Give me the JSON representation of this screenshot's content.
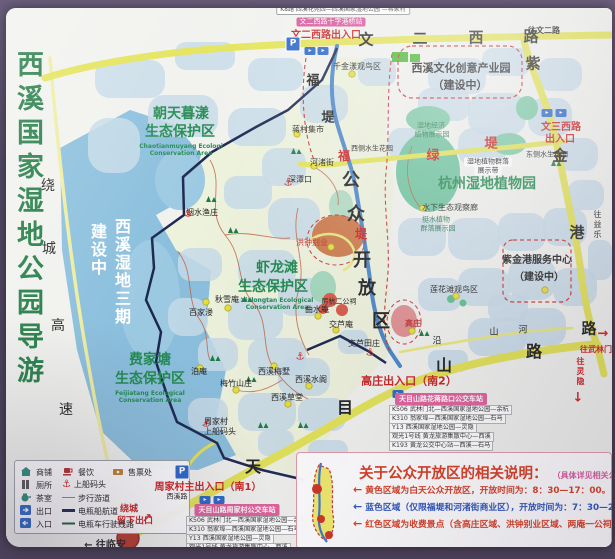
{
  "poster": {
    "title": "西溪国家湿地公园导游图"
  },
  "colors": {
    "road_yellow": "#e3e356",
    "water_lake": "#8abfdd",
    "pond": "#c6dae8",
    "boundary_navy": "#1c2750",
    "accent_red": "#cc2222",
    "green_text": "#238a52",
    "frame_purple": "#564a68",
    "pink_badge": "#d8569c"
  },
  "map": {
    "road_labels": [
      {
        "t": "文",
        "x": 366,
        "y": 40,
        "s": 15,
        "b": 1
      },
      {
        "t": "二",
        "x": 420,
        "y": 39,
        "s": 15,
        "b": 1
      },
      {
        "t": "西",
        "x": 476,
        "y": 38,
        "s": 15,
        "b": 1
      },
      {
        "t": "路",
        "x": 531,
        "y": 37,
        "s": 15,
        "b": 1
      },
      {
        "t": "往文二路",
        "x": 544,
        "y": 31,
        "s": 8,
        "b": 1
      },
      {
        "t": "紫",
        "x": 533,
        "y": 64,
        "s": 15,
        "b": 1
      },
      {
        "t": "金",
        "x": 560,
        "y": 156,
        "s": 15,
        "b": 1
      },
      {
        "t": "港",
        "x": 577,
        "y": 233,
        "s": 15,
        "b": 1
      },
      {
        "t": "路",
        "x": 589,
        "y": 329,
        "s": 15,
        "b": 1
      },
      {
        "t": "绿",
        "x": 433,
        "y": 156,
        "s": 13,
        "b": 1,
        "c": "#cc2222"
      },
      {
        "t": "堤",
        "x": 491,
        "y": 144,
        "s": 13,
        "b": 1,
        "c": "#cc2222"
      },
      {
        "t": "福",
        "x": 313,
        "y": 81,
        "s": 13,
        "b": 1
      },
      {
        "t": "堤",
        "x": 328,
        "y": 118,
        "s": 13,
        "b": 1
      },
      {
        "t": "福",
        "x": 344,
        "y": 156,
        "s": 12,
        "b": 1,
        "c": "#cc2222"
      },
      {
        "t": "堤",
        "x": 361,
        "y": 234,
        "s": 12,
        "b": 1,
        "c": "#cc2222"
      },
      {
        "t": "公",
        "x": 351,
        "y": 181,
        "s": 18,
        "b": 1
      },
      {
        "t": "众",
        "x": 356,
        "y": 215,
        "s": 18,
        "b": 1
      },
      {
        "t": "开",
        "x": 362,
        "y": 261,
        "s": 18,
        "b": 1
      },
      {
        "t": "放",
        "x": 367,
        "y": 289,
        "s": 18,
        "b": 1
      },
      {
        "t": "区",
        "x": 381,
        "y": 322,
        "s": 18,
        "b": 1
      },
      {
        "t": "天",
        "x": 253,
        "y": 467,
        "s": 16,
        "b": 1
      },
      {
        "t": "目",
        "x": 345,
        "y": 408,
        "s": 16,
        "b": 1
      },
      {
        "t": "山",
        "x": 444,
        "y": 366,
        "s": 16,
        "b": 1
      },
      {
        "t": "路",
        "x": 534,
        "y": 352,
        "s": 16,
        "b": 1
      },
      {
        "t": "沿",
        "x": 437,
        "y": 342,
        "s": 9
      },
      {
        "t": "山",
        "x": 494,
        "y": 333,
        "s": 9
      },
      {
        "t": "河",
        "x": 523,
        "y": 331,
        "s": 9
      },
      {
        "t": "绕",
        "x": 48,
        "y": 186,
        "s": 14
      },
      {
        "t": "城",
        "x": 49,
        "y": 249,
        "s": 14
      },
      {
        "t": "高",
        "x": 58,
        "y": 326,
        "s": 14
      },
      {
        "t": "速",
        "x": 66,
        "y": 410,
        "s": 14
      },
      {
        "t": "往武林门",
        "x": 596,
        "y": 350,
        "s": 8,
        "c": "#cc2222",
        "b": 1
      },
      {
        "t": "→",
        "x": 603,
        "y": 334,
        "s": 13,
        "c": "#cc2222",
        "b": 1
      },
      {
        "t": "往灵隐",
        "x": 580,
        "y": 372,
        "s": 8,
        "c": "#cc2222",
        "v": 1,
        "b": 1
      },
      {
        "t": "↓",
        "x": 578,
        "y": 398,
        "s": 13,
        "c": "#cc2222",
        "b": 1
      },
      {
        "t": "往益乐",
        "x": 597,
        "y": 225,
        "s": 8,
        "v": 1
      },
      {
        "t": "← 往临安",
        "x": 105,
        "y": 546,
        "s": 10,
        "b": 1
      },
      {
        "t": "↗",
        "x": 147,
        "y": 518,
        "s": 12,
        "c": "#cc2222",
        "b": 1
      }
    ],
    "area_labels": [
      {
        "t": "朝天暮漾",
        "x": 181,
        "y": 114,
        "s": 14,
        "c": "#238a52",
        "b": 1
      },
      {
        "t": "生态保护区",
        "x": 180,
        "y": 132,
        "s": 14,
        "c": "#238a52",
        "b": 1
      },
      {
        "t": "Chaotianmuyang Ecologi",
        "x": 181,
        "y": 147,
        "s": 6,
        "c": "#238a52",
        "b": 1
      },
      {
        "t": "Conservation Area",
        "x": 181,
        "y": 154,
        "s": 6,
        "c": "#238a52",
        "b": 1
      },
      {
        "t": "虾龙滩",
        "x": 277,
        "y": 268,
        "s": 14,
        "c": "#238a52",
        "b": 1
      },
      {
        "t": "生态保护区",
        "x": 273,
        "y": 287,
        "s": 14,
        "c": "#238a52",
        "b": 1
      },
      {
        "t": "Xialongtan Ecological",
        "x": 277,
        "y": 301,
        "s": 6,
        "c": "#238a52",
        "b": 1
      },
      {
        "t": "Conservation Area",
        "x": 277,
        "y": 308,
        "s": 6,
        "c": "#238a52",
        "b": 1
      },
      {
        "t": "费家塘",
        "x": 150,
        "y": 360,
        "s": 14,
        "c": "#238a52",
        "b": 1
      },
      {
        "t": "生态保护区",
        "x": 150,
        "y": 379,
        "s": 14,
        "c": "#238a52",
        "b": 1
      },
      {
        "t": "Feijiatang Ecological",
        "x": 150,
        "y": 394,
        "s": 6,
        "c": "#238a52",
        "b": 1
      },
      {
        "t": "Conservation Area",
        "x": 150,
        "y": 401,
        "s": 6,
        "c": "#238a52",
        "b": 1
      },
      {
        "t": "杭州湿地植物园",
        "x": 487,
        "y": 184,
        "s": 14,
        "c": "#1f8a4d",
        "b": 1
      },
      {
        "t": "西溪文化创意产业园",
        "x": 461,
        "y": 68,
        "s": 11,
        "b": 1
      },
      {
        "t": "（建设中）",
        "x": 460,
        "y": 85,
        "s": 11,
        "b": 1
      },
      {
        "t": "紫金港服务中心",
        "x": 537,
        "y": 261,
        "s": 10,
        "b": 1
      },
      {
        "t": "（建设中）",
        "x": 539,
        "y": 278,
        "s": 10,
        "b": 1
      },
      {
        "t": "西溪湿地三期",
        "x": 121,
        "y": 272,
        "s": 16,
        "c": "#ffffff",
        "v": 1,
        "b": 1
      },
      {
        "t": "建设中",
        "x": 97,
        "y": 250,
        "s": 16,
        "c": "#ffffff",
        "v": 1,
        "b": 1
      }
    ],
    "place_labels": [
      {
        "t": "蒋村集市",
        "x": 308,
        "y": 130,
        "s": 8
      },
      {
        "t": "河渚街",
        "x": 322,
        "y": 163,
        "s": 8
      },
      {
        "t": "深潭口",
        "x": 300,
        "y": 180,
        "s": 8
      },
      {
        "t": "烟水渔庄",
        "x": 202,
        "y": 213,
        "s": 8
      },
      {
        "t": "洪钟别业",
        "x": 312,
        "y": 243,
        "s": 8,
        "c": "#c03333"
      },
      {
        "t": "百家溇",
        "x": 201,
        "y": 313,
        "s": 8
      },
      {
        "t": "秋雪庵",
        "x": 227,
        "y": 300,
        "s": 8
      },
      {
        "t": "泊庵",
        "x": 199,
        "y": 372,
        "s": 8
      },
      {
        "t": "梅竹山庄",
        "x": 236,
        "y": 384,
        "s": 8
      },
      {
        "t": "西溪梅墅",
        "x": 274,
        "y": 372,
        "s": 8
      },
      {
        "t": "西溪水阁",
        "x": 311,
        "y": 380,
        "s": 8
      },
      {
        "t": "西溪草堂",
        "x": 287,
        "y": 398,
        "s": 8
      },
      {
        "t": "曲水庵",
        "x": 317,
        "y": 310,
        "s": 8
      },
      {
        "t": "厉杭二公祠",
        "x": 339,
        "y": 302,
        "s": 7
      },
      {
        "t": "交芦庵",
        "x": 341,
        "y": 325,
        "s": 8
      },
      {
        "t": "交芦田庄",
        "x": 364,
        "y": 344,
        "s": 8
      },
      {
        "t": "周家村",
        "x": 216,
        "y": 422,
        "s": 8
      },
      {
        "t": "上船码头",
        "x": 220,
        "y": 432,
        "s": 8
      },
      {
        "t": "高庄",
        "x": 413,
        "y": 324,
        "s": 8,
        "c": "#c03333",
        "b": 1
      },
      {
        "t": "西溪路",
        "x": 177,
        "y": 497,
        "s": 7
      },
      {
        "t": "千金漾观鸟区",
        "x": 357,
        "y": 67,
        "s": 8
      },
      {
        "t": "莲花滩观鸟区",
        "x": 454,
        "y": 290,
        "s": 8
      },
      {
        "t": "东侧水生花园",
        "x": 547,
        "y": 155,
        "s": 7
      },
      {
        "t": "西侧水生花园",
        "x": 372,
        "y": 149,
        "s": 7
      },
      {
        "t": "水下生态观察廊",
        "x": 450,
        "y": 208,
        "s": 8
      },
      {
        "t": "湿地经济",
        "x": 431,
        "y": 126,
        "s": 7,
        "c": "#2e7d4f"
      },
      {
        "t": "植物展示园",
        "x": 432,
        "y": 135,
        "s": 7,
        "c": "#2e7d4f"
      },
      {
        "t": "湿地植物群落",
        "x": 488,
        "y": 162,
        "s": 7,
        "bg": "#ffffff"
      },
      {
        "t": "展示带",
        "x": 488,
        "y": 171,
        "s": 7,
        "bg": "#ffffff"
      },
      {
        "t": "挺水植物",
        "x": 436,
        "y": 220,
        "s": 7,
        "c": "#2e7d4f"
      },
      {
        "t": "群落展示园",
        "x": 438,
        "y": 229,
        "s": 7,
        "c": "#2e7d4f"
      }
    ],
    "gate_labels": [
      {
        "t": "文二西路出入口",
        "x": 326,
        "y": 36,
        "s": 10,
        "c": "#cc2222",
        "b": 1
      },
      {
        "t": "文三西路",
        "x": 561,
        "y": 128,
        "s": 10,
        "c": "#cc2222",
        "b": 1
      },
      {
        "t": "出入口",
        "x": 560,
        "y": 140,
        "s": 10,
        "c": "#cc2222",
        "b": 1
      },
      {
        "t": "高庄出入口（南2）",
        "x": 409,
        "y": 381,
        "s": 11,
        "c": "#cc2222",
        "b": 1
      },
      {
        "t": "周家村主出入口（南1）",
        "x": 208,
        "y": 488,
        "s": 10,
        "c": "#cc2222",
        "b": 1
      },
      {
        "t": "绕城",
        "x": 129,
        "y": 510,
        "s": 9,
        "c": "#cc2222",
        "b": 1
      },
      {
        "t": "留下出口",
        "x": 135,
        "y": 522,
        "s": 9,
        "c": "#cc2222",
        "b": 1
      }
    ],
    "badges": [
      {
        "t": "K8路 西溪花苑西—西溪国家湿地公园 —蒋家村",
        "x": 343,
        "y": 10,
        "s": 6,
        "c": "#333333",
        "bg": "#ffffff",
        "br": 1
      },
      {
        "t": "文二西路十字港桥站",
        "x": 331,
        "y": 22,
        "s": 7,
        "c": "#ffffff",
        "bg": "#d8569c"
      }
    ],
    "markers": {
      "anchors": [
        [
          288,
          183
        ],
        [
          188,
          214
        ],
        [
          206,
          424
        ],
        [
          370,
          353
        ],
        [
          300,
          357
        ]
      ],
      "parkings": [
        [
          293,
          44
        ],
        [
          182,
          472
        ]
      ],
      "gates": [
        [
          310,
          51
        ],
        [
          323,
          51
        ],
        [
          547,
          113
        ],
        [
          561,
          113
        ],
        [
          205,
          500
        ],
        [
          219,
          500
        ],
        [
          398,
          394
        ]
      ]
    }
  },
  "legend": {
    "items": [
      {
        "icon": "shop-icon",
        "label": "商铺",
        "x": 20,
        "y": 466
      },
      {
        "icon": "dining-icon",
        "label": "餐饮",
        "x": 62,
        "y": 466
      },
      {
        "icon": "ticket-icon",
        "label": "售票处",
        "x": 112,
        "y": 466
      },
      {
        "icon": "toilet-icon",
        "label": "厕所",
        "x": 20,
        "y": 479
      },
      {
        "icon": "dock-icon",
        "label": "上船码头",
        "x": 62,
        "y": 479
      },
      {
        "icon": "tea-icon",
        "label": "茶室",
        "x": 20,
        "y": 492
      },
      {
        "icon": "walk-line-icon",
        "label": "步行游道",
        "x": 62,
        "y": 492
      },
      {
        "icon": "exit-icon",
        "label": "出口",
        "x": 20,
        "y": 505
      },
      {
        "icon": "boat-line-icon",
        "label": "电瓶船航道",
        "x": 62,
        "y": 505
      },
      {
        "icon": "entrance-icon",
        "label": "入口",
        "x": 20,
        "y": 518
      },
      {
        "icon": "cart-line-icon",
        "label": "电瓶车行驶线路",
        "x": 62,
        "y": 518
      }
    ]
  },
  "bus_stations": [
    {
      "header": "天目山路花蒋路口公交车站",
      "hx": 441,
      "hy": 399,
      "rx": 389,
      "ry": 405,
      "routes": [
        "K506 武林门北—西溪国家湿地公园—余杭",
        "K310 翁家埠—西溪国家湿地公园—石马",
        "Y13 西溪国家湿地公园—灵隐",
        "观光1号线 黄龙旅游集散中心—西溪",
        "K193 黄龙公交中心站—西溪—石马"
      ]
    },
    {
      "header": "天目山路周家村公交车站",
      "hx": 237,
      "hy": 510,
      "rx": 186,
      "ry": 516,
      "routes": [
        "K506 武林门北—西溪国家湿地公园—余杭",
        "K310 翁家埠—西溪国家湿地公园—石马",
        "Y13 西溪国家湿地公园—灵隐",
        "观光1号线 黄龙旅游集散中心—西溪",
        "K193 黄龙公交中心站—西溪—石马"
      ]
    }
  ],
  "info_box": {
    "title": "关于公众开放区的相关说明：",
    "note": "（具体详见相关公园公告）",
    "lines": [
      {
        "text": "黄色区域为白天公众开放区，开放时间为：8：30—17：00。",
        "color": "#d83a20"
      },
      {
        "text": "蓝色区域（仅限福堤和河渚街商业区），开放时间为：7：30—21：00",
        "color": "#2a52be"
      },
      {
        "text": "红色区域为收费景点（含高庄区域、洪钟别业区域、两庵一公祠区域）。",
        "color": "#d83a20"
      }
    ]
  }
}
